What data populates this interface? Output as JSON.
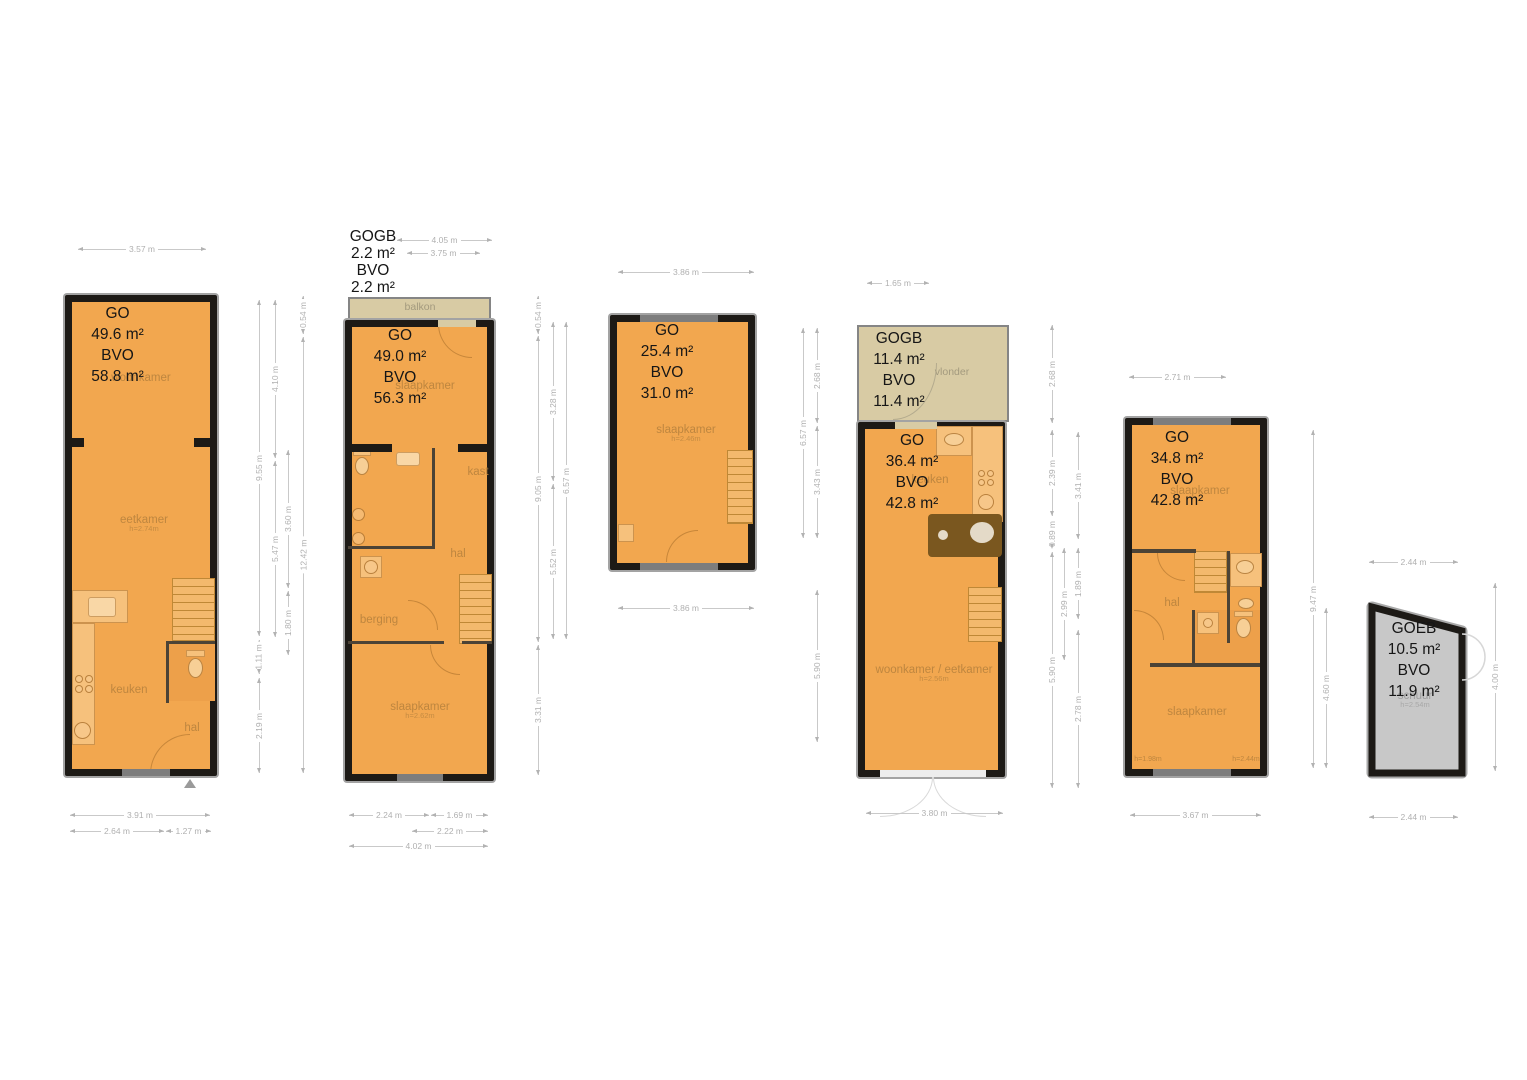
{
  "sheet": {
    "background": "#ffffff"
  },
  "colors": {
    "room_fill": "#f2a74f",
    "wall": "#1d1a16",
    "annex_fill": "#d8cba4",
    "shed_fill": "#c8c8c8",
    "dim_text": "#b0b0b0",
    "room_label": "#bc8742"
  },
  "plans": [
    {
      "stats": [
        "GO",
        "49.6 m²",
        "BVO",
        "58.8 m²"
      ],
      "rooms": {
        "woonkamer": {
          "label": "woonkamer"
        },
        "eetkamer": {
          "label": "eetkamer",
          "h": "h=2.74m"
        },
        "keuken": {
          "label": "keuken"
        },
        "hal": {
          "label": "hal"
        }
      },
      "dims": {
        "top": "3.57 m",
        "r1": [
          "9.55 m",
          "1.11 m",
          "2.19 m"
        ],
        "r2": [
          "4.10 m",
          "5.47 m"
        ],
        "r3": [
          "3.60 m",
          "1.80 m"
        ],
        "r4": [
          "0.54 m",
          "12.42 m"
        ],
        "bottom": [
          "3.91 m",
          "2.64 m",
          "1.27 m"
        ]
      }
    },
    {
      "annex_stats": [
        "GOGB",
        "2.2 m²",
        "BVO",
        "2.2 m²"
      ],
      "annex_label": "balkon",
      "stats": [
        "GO",
        "49.0 m²",
        "BVO",
        "56.3 m²"
      ],
      "rooms": {
        "slaapkamer_top": {
          "label": "slaapkamer"
        },
        "kast": {
          "label": "kast"
        },
        "hal": {
          "label": "hal"
        },
        "berging": {
          "label": "berging"
        },
        "slaapkamer_bottom": {
          "label": "slaapkamer",
          "h": "h=2.62m"
        }
      },
      "dims": {
        "top": [
          "4.05 m",
          "3.75 m"
        ],
        "r1": [
          "0.54 m",
          "9.05 m",
          "3.31 m"
        ],
        "r2": [
          "3.28 m",
          "5.52 m"
        ],
        "r3": [
          "6.57 m"
        ],
        "bottom": [
          "2.24 m",
          "1.69 m",
          "2.22 m",
          "4.02 m"
        ]
      }
    },
    {
      "stats": [
        "GO",
        "25.4 m²",
        "BVO",
        "31.0 m²"
      ],
      "rooms": {
        "slaapkamer": {
          "label": "slaapkamer",
          "h": "h=2.46m"
        }
      },
      "dims": {
        "top": "3.86 m",
        "r1": [
          "6.57 m"
        ],
        "r2": [
          "2.68 m",
          "3.43 m",
          "5.90 m"
        ],
        "bottom": "3.86 m"
      }
    },
    {
      "annex_stats": [
        "GOGB",
        "11.4 m²",
        "BVO",
        "11.4 m²"
      ],
      "annex_label": "vlonder",
      "stats": [
        "GO",
        "36.4 m²",
        "BVO",
        "42.8 m²"
      ],
      "rooms": {
        "keuken": {
          "label": "keuken"
        },
        "woonkamer": {
          "label": "woonkamer / eetkamer",
          "h": "h=2.56m"
        }
      },
      "dims": {
        "top": "1.65 m",
        "r1": [
          "2.68 m",
          "2.39 m",
          "0.89 m",
          "5.90 m"
        ],
        "r2": [
          "2.99 m"
        ],
        "r3": [
          "3.41 m",
          "1.89 m",
          "2.78 m"
        ],
        "bottom": "3.80 m"
      }
    },
    {
      "stats": [
        "GO",
        "34.8 m²",
        "BVO",
        "42.8 m²"
      ],
      "rooms": {
        "slaapkamer_top": {
          "label": "slaapkamer"
        },
        "hal": {
          "label": "hal"
        },
        "slaapkamer_bottom": {
          "label": "slaapkamer"
        },
        "h_left": "h=1.98m",
        "h_right": "h=2.44m"
      },
      "dims": {
        "top": "2.71 m",
        "r1": [
          "9.47 m"
        ],
        "r2": [
          "4.60 m"
        ],
        "bottom": "3.67 m"
      }
    },
    {
      "stats": [
        "GOEB",
        "10.5 m²",
        "BVO",
        "11.9 m²"
      ],
      "rooms": {
        "schuur": {
          "label": "schuur",
          "h": "h=2.54m"
        }
      },
      "dims": {
        "top": "2.44 m",
        "right": "4.00 m",
        "bottom": "2.44 m"
      }
    }
  ]
}
